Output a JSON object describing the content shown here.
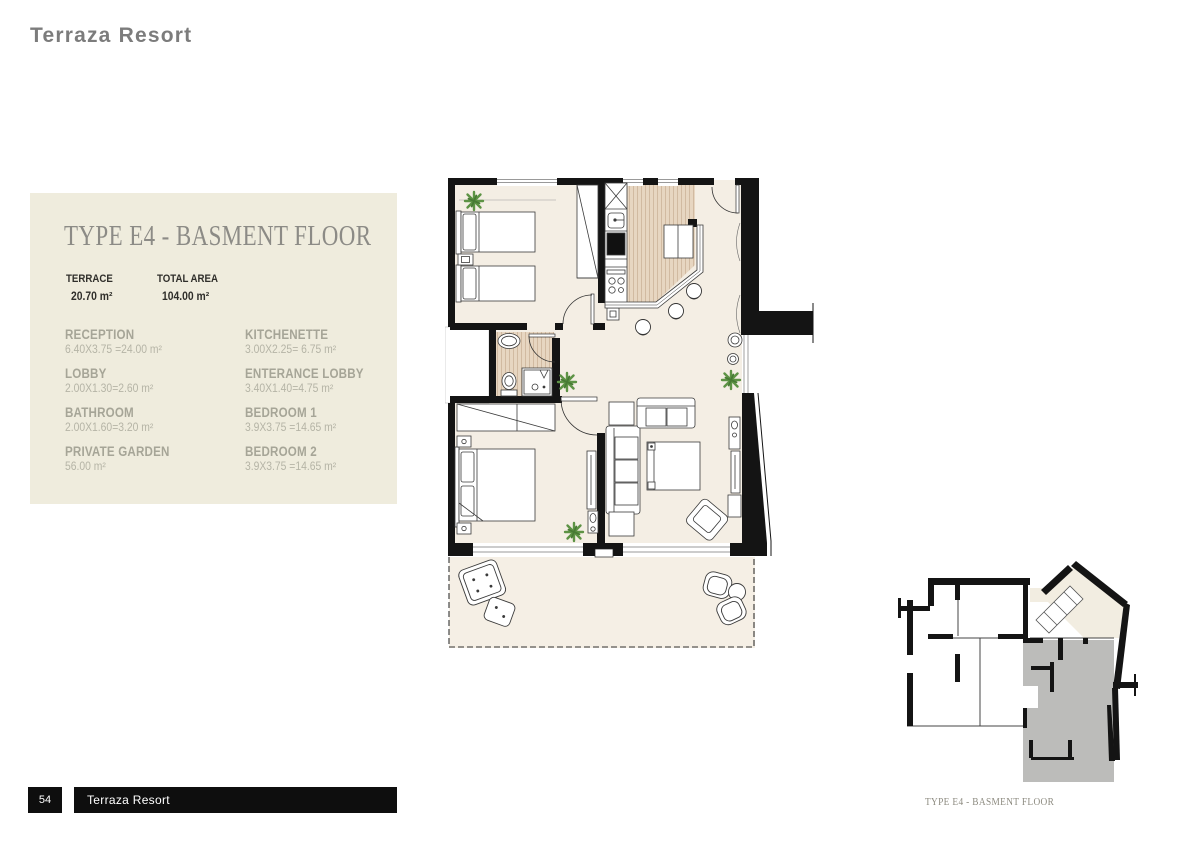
{
  "header": {
    "title": "Terraza Resort"
  },
  "panel": {
    "title": "TYPE E4 - BASMENT FLOOR",
    "stats": [
      {
        "label": "TERRACE",
        "value": "20.70 m²"
      },
      {
        "label": "TOTAL AREA",
        "value": "104.00 m²"
      }
    ],
    "rooms": [
      {
        "name": "RECEPTION",
        "dims": "6.40X3.75 =24.00 m²"
      },
      {
        "name": "LOBBY",
        "dims": "2.00X1.30=2.60 m²"
      },
      {
        "name": "BATHROOM",
        "dims": "2.00X1.60=3.20 m²"
      },
      {
        "name": "PRIVATE GARDEN",
        "dims": "56.00 m²"
      },
      {
        "name": "KITCHENETTE",
        "dims": "3.00X2.25= 6.75 m²"
      },
      {
        "name": "ENTERANCE LOBBY",
        "dims": "3.40X1.40=4.75 m²"
      },
      {
        "name": "BEDROOM 1",
        "dims": "3.9X3.75 =14.65 m²"
      },
      {
        "name": "BEDROOM 2",
        "dims": "3.9X3.75 =14.65 m²"
      }
    ]
  },
  "mini_plan": {
    "caption": "TYPE E4 - BASMENT FLOOR"
  },
  "footer": {
    "page_number": "54",
    "title": "Terraza Resort"
  },
  "colors": {
    "panel_bg": "#efecdd",
    "floor_beige": "#f4eee4",
    "wood_floor": "#e7d6c1",
    "wall_black": "#141414",
    "unit_highlight_gray": "#bcbcba",
    "plant_green": "#5d9345",
    "footer_bg": "#0e0e0e",
    "room_name_text": "#a6a597",
    "panel_title_text": "#8c8b86",
    "header_text": "#7c7c7c"
  }
}
